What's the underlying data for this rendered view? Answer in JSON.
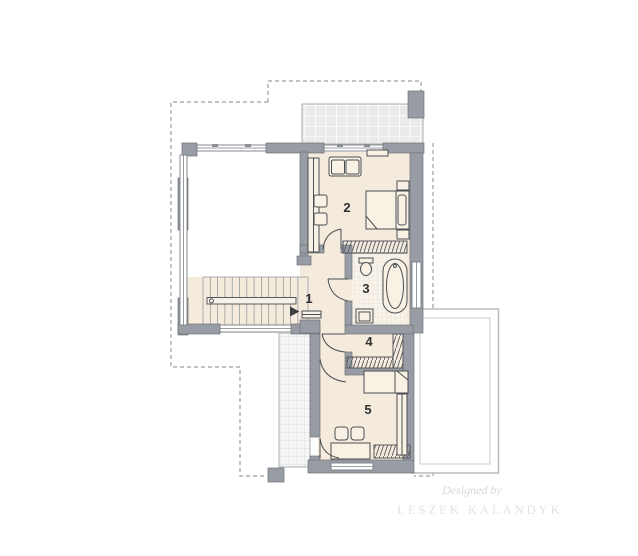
{
  "plan": {
    "title": "second-floor-plan",
    "rooms": [
      {
        "number": "1",
        "type": "hall-landing"
      },
      {
        "number": "2",
        "type": "bedroom"
      },
      {
        "number": "3",
        "type": "bathroom"
      },
      {
        "number": "4",
        "type": "wardrobe"
      },
      {
        "number": "5",
        "type": "bedroom"
      }
    ],
    "watermark": {
      "script": "Designed by",
      "name": "LESZEK KALANDYK"
    }
  },
  "colors": {
    "wall": "#989da5",
    "floor": "#f5ebdd",
    "bath_tile": "#f8f3ea",
    "terrace_tile": "#e9eaea",
    "balcony_tile": "#f6f6f6",
    "outline": "#6f7277",
    "furniture_line": "#4a4e52",
    "dashed": "#9aa0a4",
    "roof_outline": "#b9bcbd",
    "label": "#2f3133",
    "watermark_script": "#d7d7da",
    "watermark_caps": "#e3e3e6"
  }
}
